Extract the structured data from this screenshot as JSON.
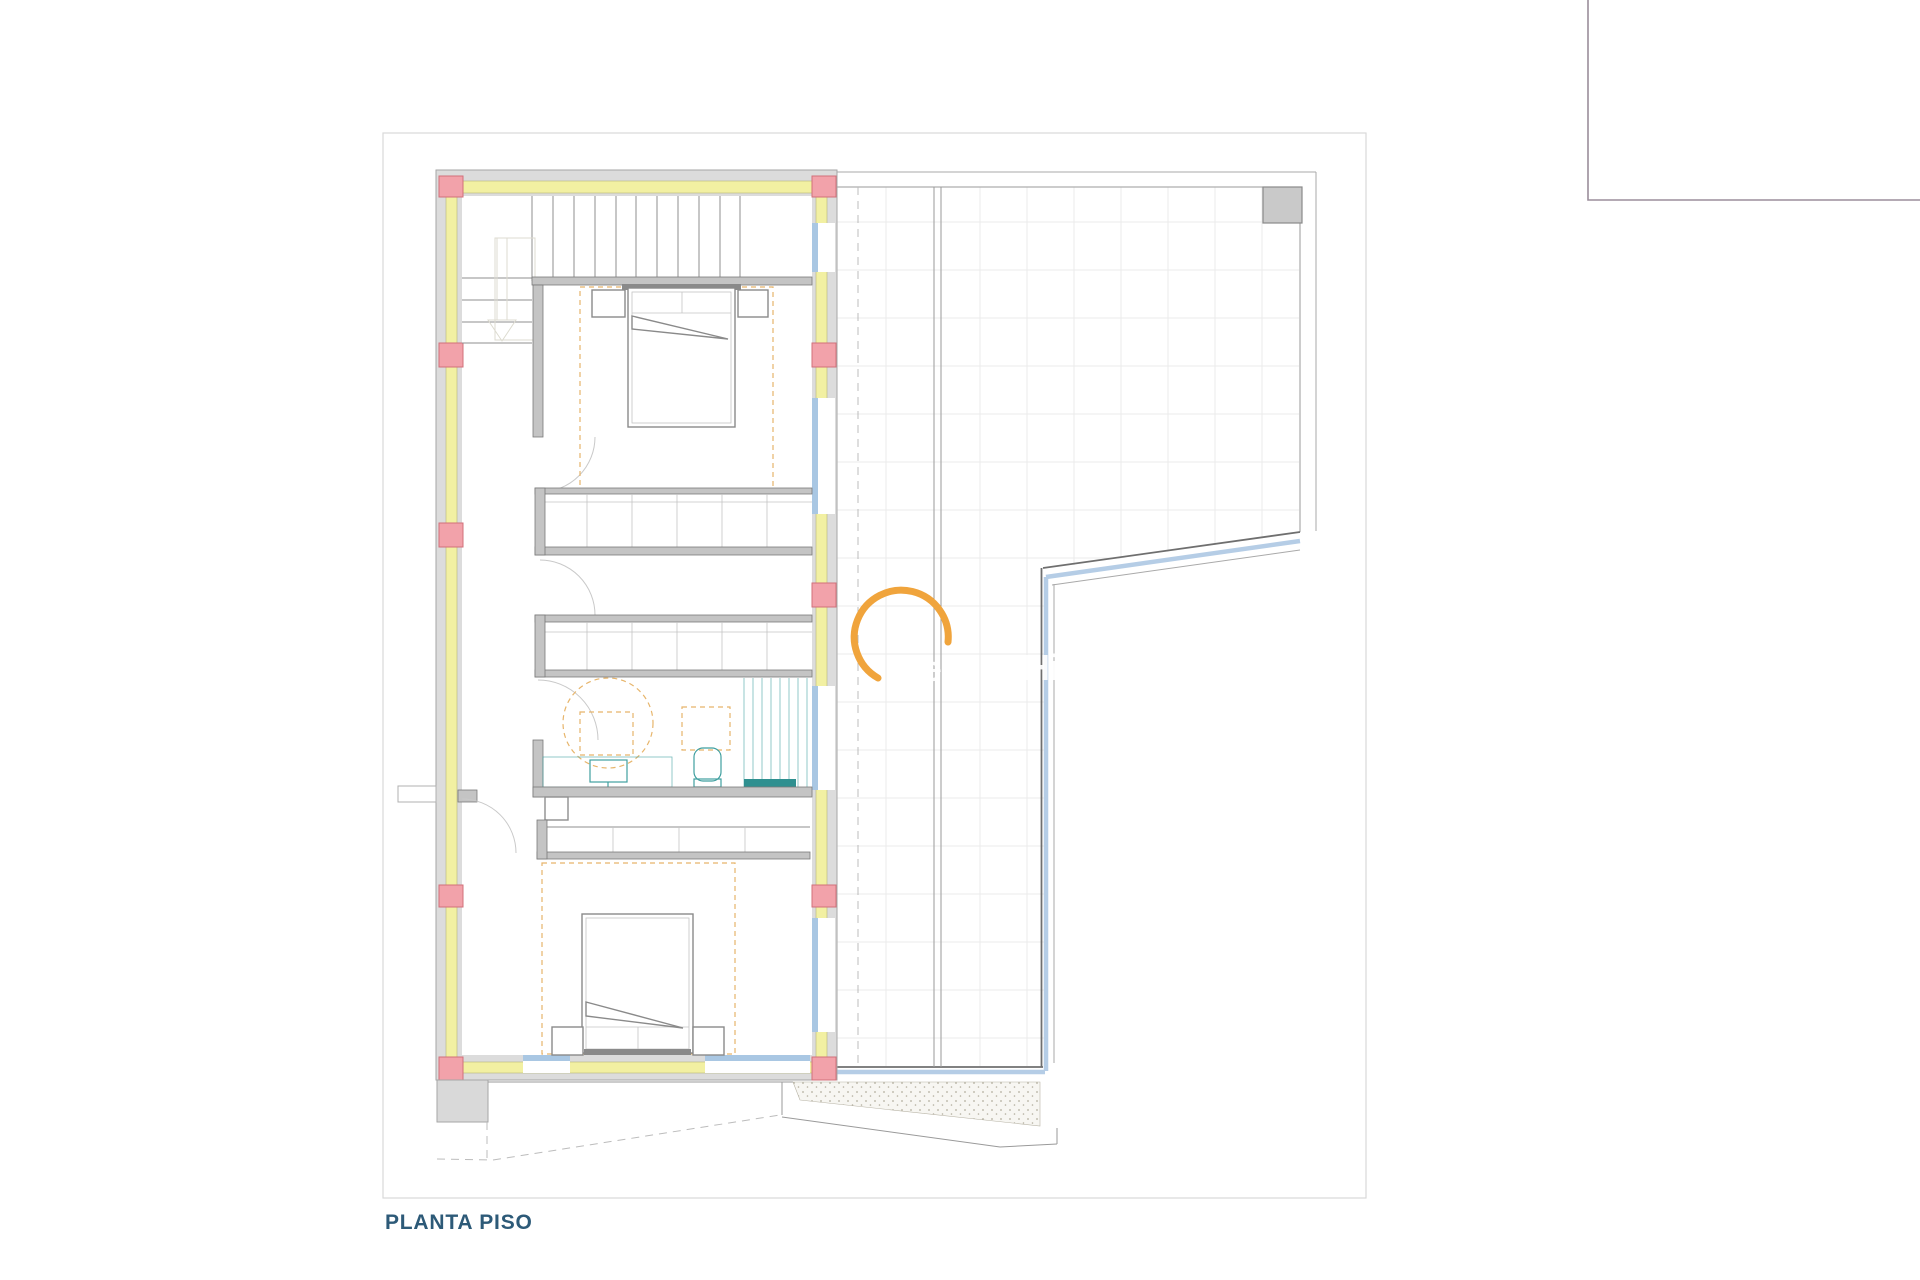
{
  "title": {
    "text": "PLANTA PISO"
  },
  "watermark": {
    "letters": [
      "e",
      "H",
      "i"
    ]
  },
  "colors": {
    "page_bg": "#ffffff",
    "sheet_border": "#d9d9d9",
    "wall_fill": "#dcdcdc",
    "wall_edge": "#a6a6a6",
    "insulation": "#f2f0a2",
    "insulation_edge": "#b4b478",
    "column_fill": "#f2a2aa",
    "column_edge": "#d2707a",
    "window_blue": "#a9c7e3",
    "partition_fill": "#c4c4c4",
    "partition_edge": "#7a7a7a",
    "furniture": "#8a8a8a",
    "accent_dashed": "#e7b56b",
    "fixture_teal": "#3f9f9f",
    "fixture_teal_dark": "#2f9090",
    "grid": "#ebebeb",
    "balustrade_dark": "#6f6f6f",
    "balustrade_blue": "#b5cde6",
    "balustrade_light": "#a9a9a9",
    "stipple_dot": "#b3ae9e",
    "watermark_orange": "#f0a43c",
    "title_color": "#2d5a78",
    "frame_topright": "#9b8e9b"
  }
}
